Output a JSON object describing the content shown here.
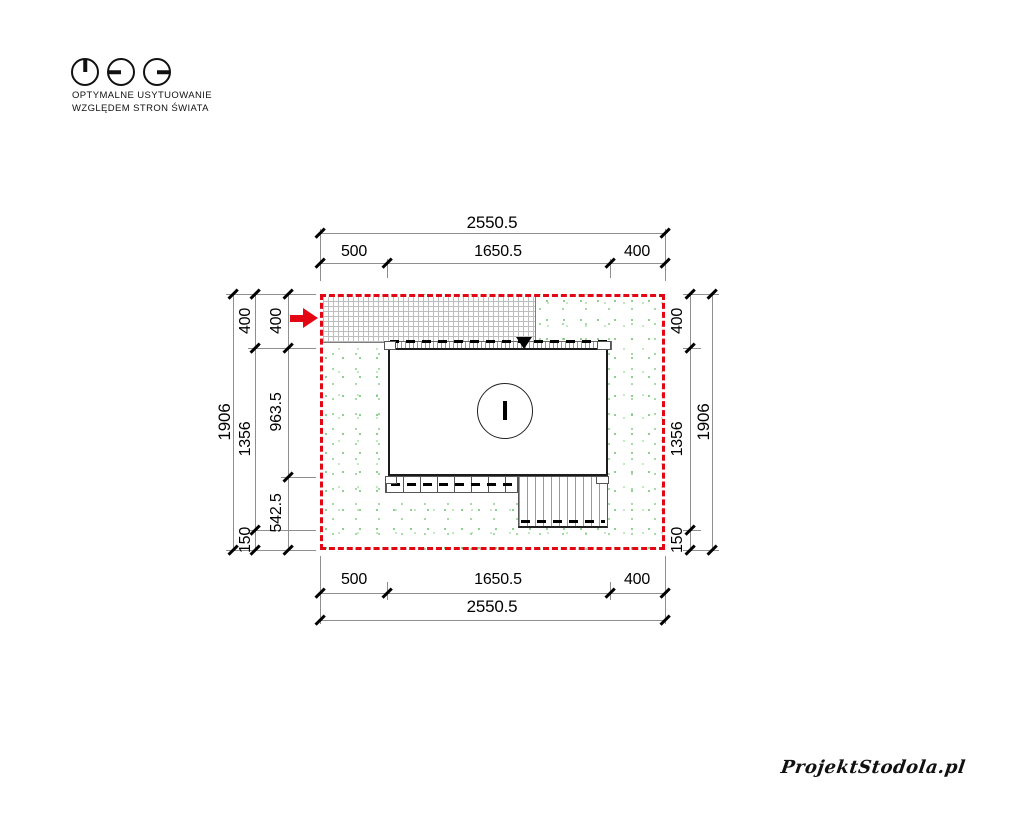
{
  "legend": {
    "icons": [
      "dial-hand-up-icon",
      "dial-hand-left-icon",
      "dial-hand-right-icon"
    ],
    "caption_line1": "OPTYMALNE USYTUOWANIE",
    "caption_line2": "WZGLĘDEM STRON ŚWIATA"
  },
  "plan": {
    "building_label": "I"
  },
  "dimensions": {
    "top": {
      "total": "2550.5",
      "segments": [
        "500",
        "1650.5",
        "400"
      ]
    },
    "bottom": {
      "total": "2550.5",
      "segments": [
        "500",
        "1650.5",
        "400"
      ]
    },
    "left": {
      "total": "1906",
      "outer": [
        "400",
        "1356",
        "150"
      ],
      "inner": [
        "400",
        "963.5",
        "542.5"
      ]
    },
    "right": {
      "total": "1906",
      "segments": [
        "400",
        "1356",
        "150"
      ]
    }
  },
  "footer": {
    "logo": "ProjektStodola.pl"
  },
  "colors": {
    "boundary_red": "#e30613",
    "grass_green": "#7cc87c"
  }
}
